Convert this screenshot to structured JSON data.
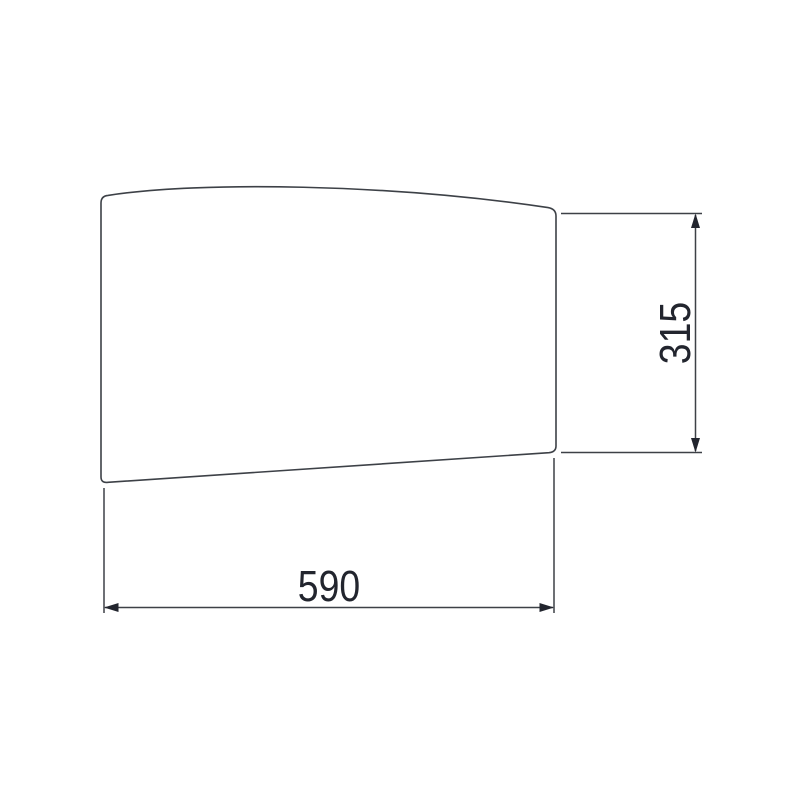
{
  "drawing": {
    "type": "technical dimension drawing",
    "shape": "panel with arched top edge, vertical sides and sloped bottom edge",
    "width_dimension": {
      "label": "590",
      "orientation": "horizontal"
    },
    "height_dimension": {
      "label": "315",
      "orientation": "vertical"
    }
  },
  "colors": {
    "line": "#3d4147",
    "ink": "#22252e",
    "bg": "#ffffff"
  }
}
